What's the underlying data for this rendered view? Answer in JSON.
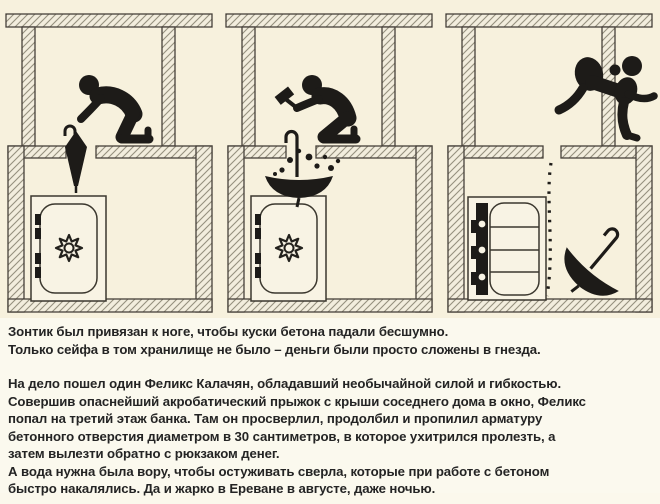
{
  "illustration": {
    "background_color": "#f7f1dd",
    "ink_color": "#1d1b18",
    "wall_line_color": "#46413a",
    "hatch_line_color": "#95907e",
    "panels": [
      {
        "id": "panel-1",
        "icons": [
          "kneeling-burglar-icon",
          "closed-umbrella-icon",
          "locked-safe-icon",
          "safe-dial-icon",
          "hatched-vault-walls"
        ]
      },
      {
        "id": "panel-2",
        "icons": [
          "kneeling-burglar-icon",
          "hammer-icon",
          "open-umbrella-icon",
          "falling-debris-dots",
          "locked-safe-icon",
          "safe-dial-icon",
          "hatched-vault-walls"
        ]
      },
      {
        "id": "panel-3",
        "icons": [
          "escaping-burglar-with-rucksack-icon",
          "open-safe-with-shelves-icon",
          "dotted-descent-path",
          "discarded-umbrella-icon",
          "hatched-vault-walls"
        ]
      }
    ]
  },
  "story": {
    "text_color": "#242424",
    "para1": "Зонтик был привязан к ноге, чтобы куски бетона падали бесшумно.\nТолько сейфа в том хранилище не было – деньги были просто сложены в гнезда.",
    "para2": "На дело пошел один Феликс Калачян, обладавший необычайной силой и гибкостью.\nСовершив опаснейший акробатический прыжок с крыши соседнего дома в окно, Феликс\nпопал на третий этаж банка. Там он просверлил, продолбил и пропилил арматуру\nбетонного отверстия диаметром в 30 сантиметров, в которое ухитрился пролезть, а\nзатем вылезти обратно с рюкзаком денег.",
    "para3": "А вода нужна была вору, чтобы остуживать сверла, которые при работе с бетоном\nбыстро накалялись. Да и жарко в Ереване в августе, даже ночью."
  }
}
